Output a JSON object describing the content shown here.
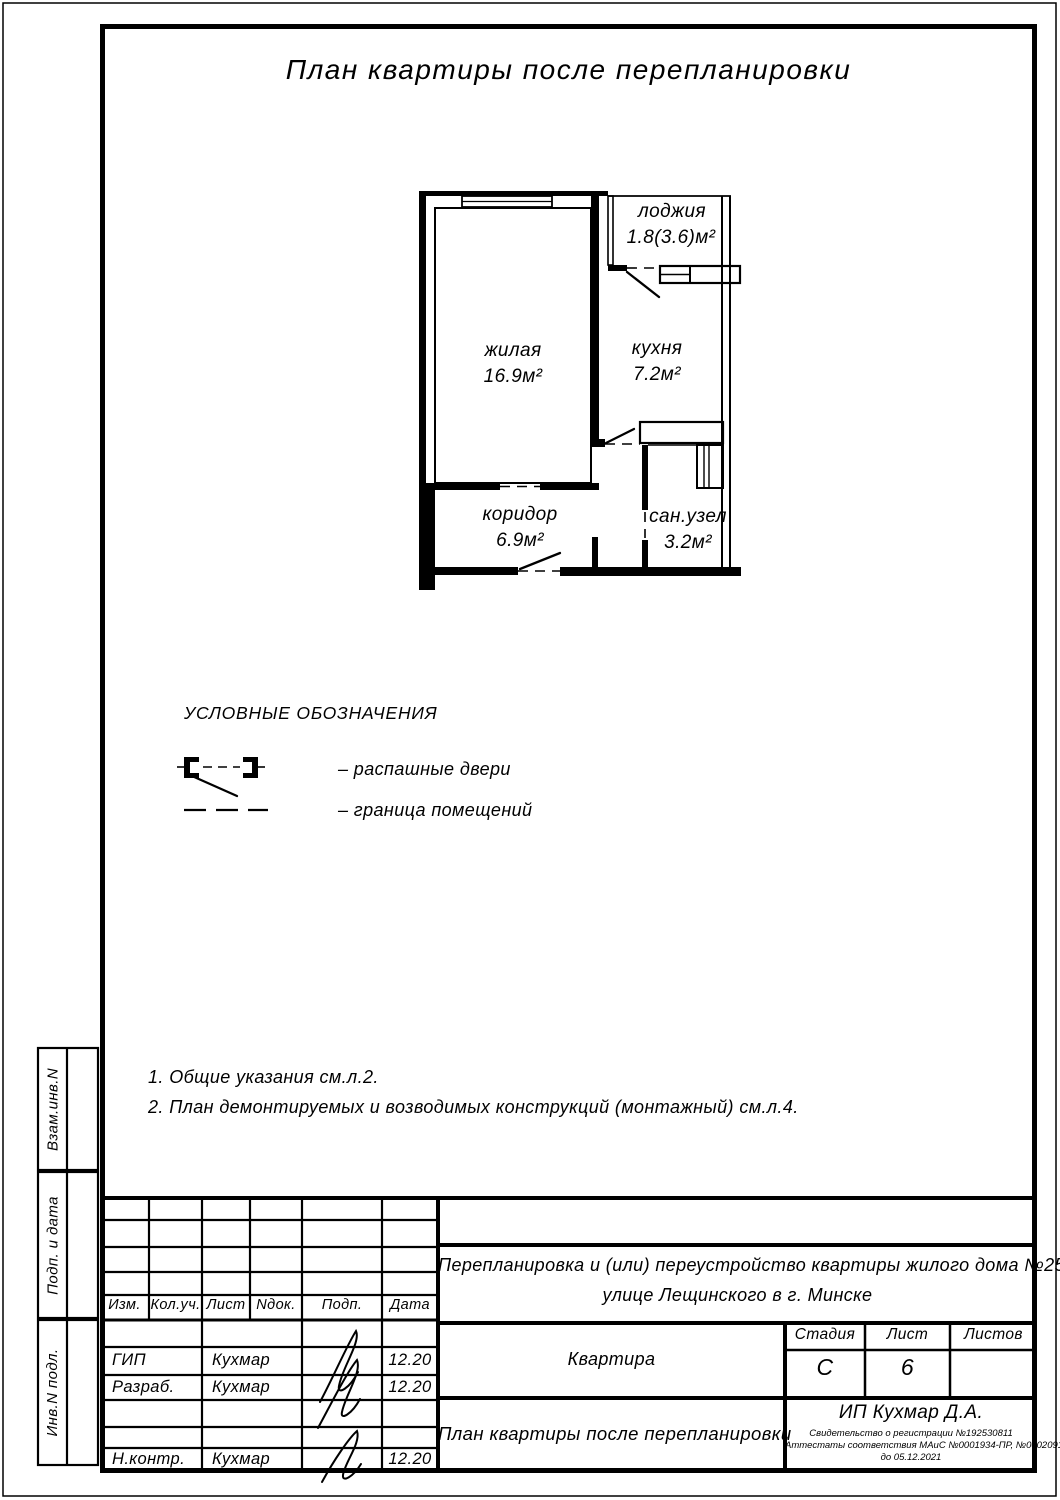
{
  "sheet": {
    "title": "План квартиры после перепланировки"
  },
  "plan": {
    "rooms": {
      "living": {
        "name": "жилая",
        "area": "16.9м²"
      },
      "kitchen": {
        "name": "кухня",
        "area": "7.2м²"
      },
      "loggia": {
        "name": "лоджия",
        "area": "1.8(3.6)м²"
      },
      "corridor": {
        "name": "коридор",
        "area": "6.9м²"
      },
      "bathroom": {
        "name": "сан.узел",
        "area": "3.2м²"
      }
    }
  },
  "legend": {
    "title": "УСЛОВНЫЕ ОБОЗНАЧЕНИЯ",
    "doors_label": "– распашные двери",
    "boundary_label": "– граница помещений"
  },
  "notes": {
    "note1": "1. Общие указания см.л.2.",
    "note2": "2. План демонтируемых и возводимых конструкций (монтажный) см.л.4."
  },
  "margins": {
    "vzam": "Взам.инв.N",
    "podp": "Подп. и дата",
    "inv": "Инв.N подл."
  },
  "titleblock": {
    "cols": {
      "izm": "Изм.",
      "koluch": "Кол.уч.",
      "list": "Лист",
      "ndok": "Nдок.",
      "podp": "Подп.",
      "data": "Дата"
    },
    "rows": {
      "gip": {
        "role": "ГИП",
        "name": "Кухмар",
        "date": "12.20"
      },
      "razrab": {
        "role": "Разраб.",
        "name": "Кухмар",
        "date": "12.20"
      },
      "nkontr": {
        "role": "Н.контр.",
        "name": "Кухмар",
        "date": "12.20"
      }
    },
    "project_line1": "Перепланировка и (или) переустройство квартиры жилого дома №25 по",
    "project_line2": "улице Лещинского в г. Минске",
    "object": "Квартира",
    "stage_label": "Стадия",
    "sheet_label": "Лист",
    "sheets_label": "Листов",
    "stage": "С",
    "sheet_no": "6",
    "sheets_total": "",
    "doc_title": "План квартиры после перепланировки",
    "company": "ИП Кухмар Д.А.",
    "cert_line1": "Свидетельство о регистрации №192530811",
    "cert_line2": "Аттестаты соответствия МАиС №0001934-ПР, №0002091-ПР",
    "cert_line3": "до 05.12.2021"
  }
}
